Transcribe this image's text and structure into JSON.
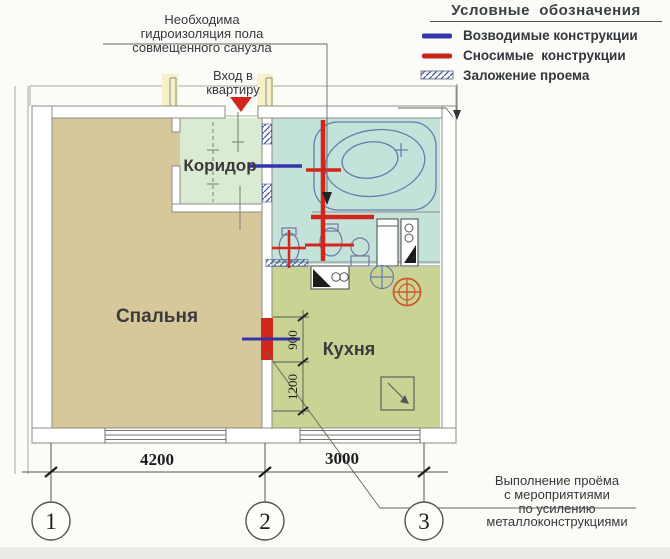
{
  "legend": {
    "title": "Условные  обозначения",
    "items": [
      {
        "label": "Возводимые конструкции",
        "swatch": "line",
        "color": "#3434ab"
      },
      {
        "label": "Сносимые  конструкции",
        "swatch": "line",
        "color": "#c8251d"
      },
      {
        "label": "Заложение проема",
        "swatch": "hatch",
        "color": "#55618f"
      }
    ]
  },
  "notes": {
    "waterproofing": {
      "line1": "Необходима",
      "line2": "гидроизоляция пола",
      "line3": "совмещенного санузла"
    },
    "entrance": {
      "line1": "Вход в",
      "line2": "квартиру"
    },
    "opening": {
      "line1": "Выполнение проёма",
      "line2": "с мероприятиями",
      "line3": "по усилению",
      "line4": "металлоконструкциями"
    }
  },
  "rooms": {
    "corridor": "Коридор",
    "bedroom": "Спальня",
    "kitchen": "Кухня"
  },
  "dimensions": {
    "span12": "4200",
    "span23": "3000",
    "opening_width": "900",
    "opening_offset": "1200"
  },
  "axes": {
    "a1": "1",
    "a2": "2",
    "a3": "3"
  },
  "colors": {
    "bedroom": "#d7c89c",
    "corridor": "#d9ecd3",
    "bathroom": "#c3e2da",
    "kitchen": "#c9d494",
    "demolition": "#d2251c",
    "construction": "#3434ab",
    "wall_line": "#8c8c85"
  }
}
